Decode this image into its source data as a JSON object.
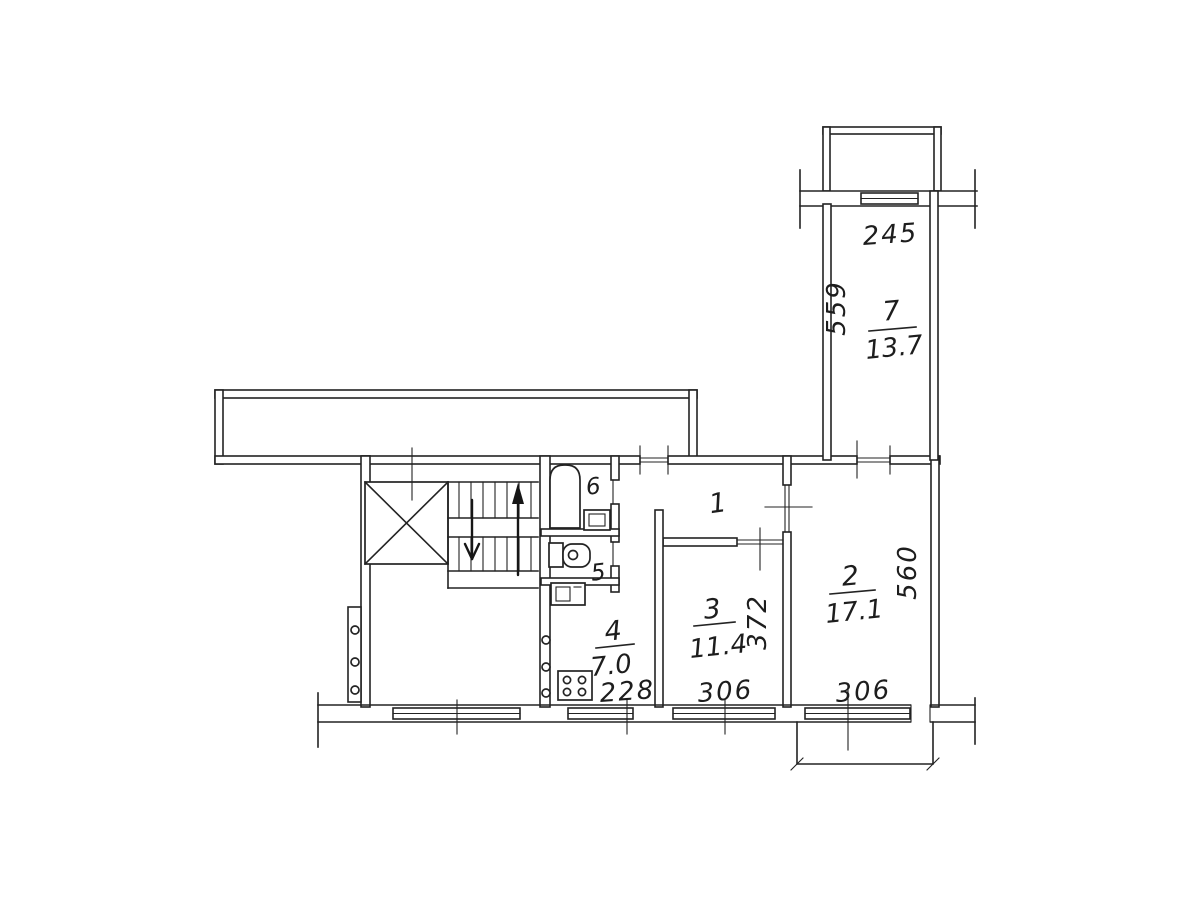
{
  "colors": {
    "ink": "#232323",
    "paper": "#ffffff"
  },
  "rooms": {
    "r1": {
      "number": "1"
    },
    "r2": {
      "number": "2",
      "area": "17.1",
      "dim_width": "306",
      "dim_height": "560"
    },
    "r3": {
      "number": "3",
      "area": "11.4",
      "dim_width": "306",
      "dim_height": "372"
    },
    "r4": {
      "number": "4",
      "area": "7.0",
      "dim_width": "228"
    },
    "r5": {
      "number": "5"
    },
    "r6": {
      "number": "6"
    },
    "r7": {
      "number": "7",
      "area": "13.7",
      "dim_width": "245",
      "dim_height": "559"
    }
  },
  "fixtures": {
    "bathtub": "bathtub",
    "bath_sink": "wash-basin",
    "toilet": "toilet",
    "kitchen_sink": "kitchen-sink",
    "stove": "stove-4-burners",
    "elevator": "elevator-shaft",
    "stairs": "staircase-two-flights"
  }
}
